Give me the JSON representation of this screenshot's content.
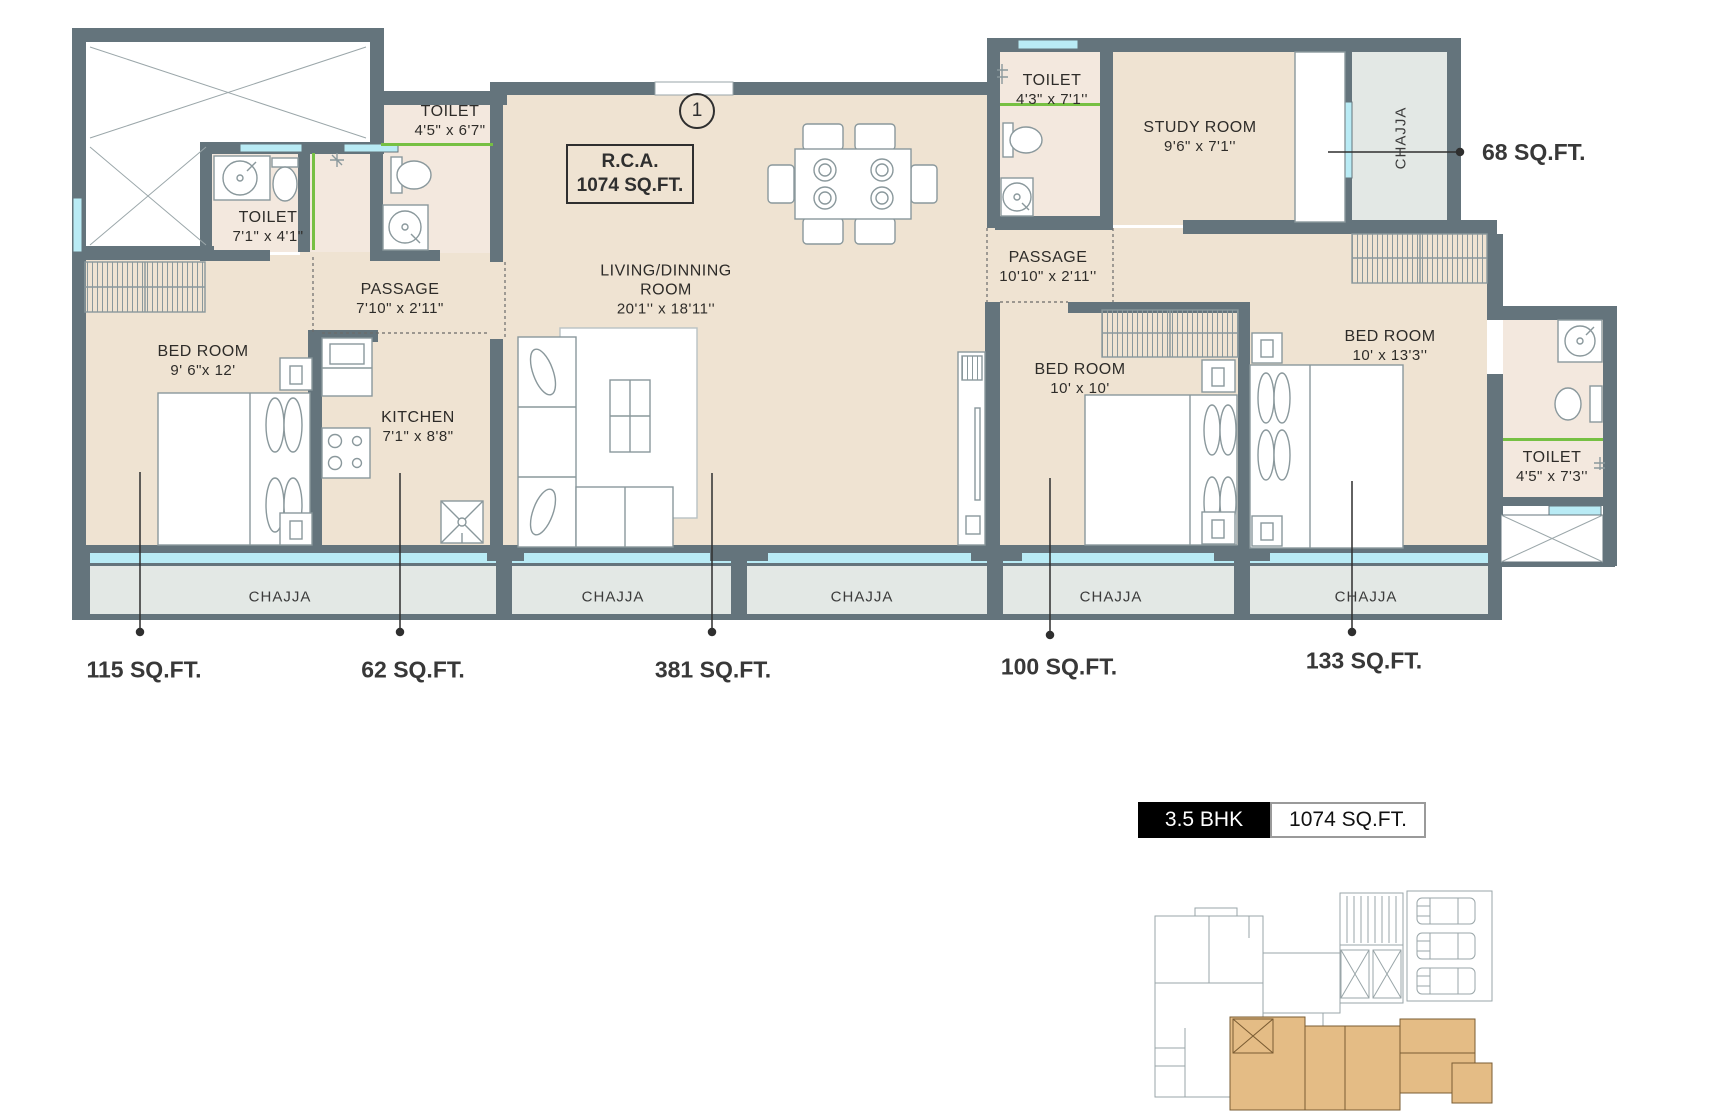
{
  "badge": {
    "bhk": "3.5 BHK",
    "area": "1074 SQ.FT."
  },
  "plan": {
    "unit_marker": "1",
    "rca": {
      "line1": "R.C.A.",
      "line2": "1074 SQ.FT."
    },
    "rooms": {
      "toilet_a": {
        "name": "TOILET",
        "dims": "7'1\" x 4'1\""
      },
      "toilet_b": {
        "name": "TOILET",
        "dims": "4'5\" x 6'7\""
      },
      "passage_left": {
        "name": "PASSAGE",
        "dims": "7'10\" x 2'11\""
      },
      "bedroom_left": {
        "name": "BED ROOM",
        "dims": "9' 6\"x 12'"
      },
      "kitchen": {
        "name": "KITCHEN",
        "dims": "7'1\" x 8'8\""
      },
      "living": {
        "name": "LIVING/DINNING",
        "name2": "ROOM",
        "dims": "20'1'' x 18'11''"
      },
      "toilet_c": {
        "name": "TOILET",
        "dims": "4'3\" x 7'1''"
      },
      "passage_right": {
        "name": "PASSAGE",
        "dims": "10'10\" x 2'11''"
      },
      "study": {
        "name": "STUDY ROOM",
        "dims": "9'6\" x 7'1''"
      },
      "bedroom_mid": {
        "name": "BED ROOM",
        "dims": "10' x 10'"
      },
      "bedroom_right": {
        "name": "BED ROOM",
        "dims": "10' x 13'3''"
      },
      "toilet_d": {
        "name": "TOILET",
        "dims": "4'5\" x 7'3''"
      }
    },
    "chajja": "CHAJJA",
    "callouts": {
      "bedroom_left": "115 SQ.FT.",
      "kitchen": "62 SQ.FT.",
      "living": "381 SQ.FT.",
      "bedroom_mid": "100 SQ.FT.",
      "bedroom_right": "133 SQ.FT.",
      "chajja_top": "68 SQ.FT."
    }
  },
  "colors": {
    "wall": "#64747c",
    "floor": "#efe3d2",
    "toilet_floor": "#f3e8de",
    "chajja": "#e3e8e5",
    "window": "#b9ebf5",
    "green_partition": "#76c043",
    "keyplan_highlight": "#e4bc85",
    "badge_dark": "#000000"
  }
}
